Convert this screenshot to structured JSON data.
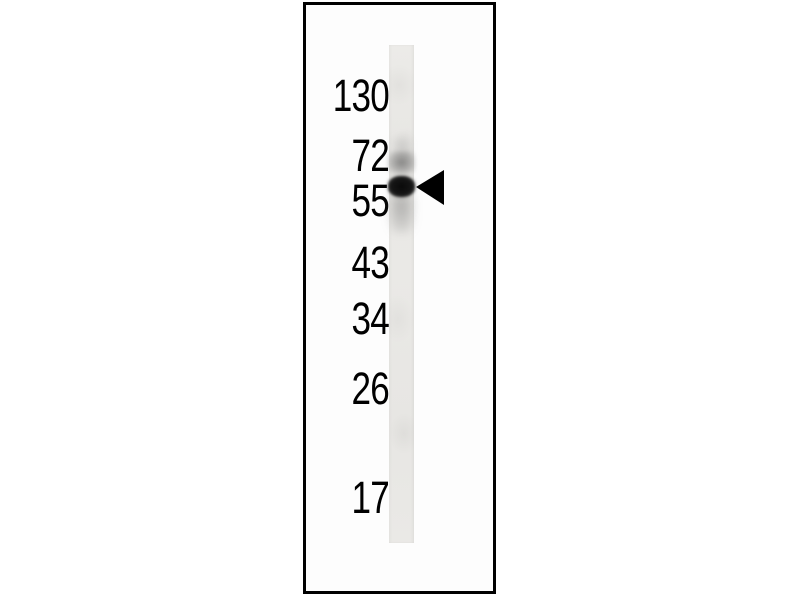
{
  "blot": {
    "figure_kind": "western-blot single lane with molecular weight ladder",
    "marker_labels": [
      "130",
      "72",
      "55",
      "43",
      "34",
      "26",
      "17"
    ],
    "bands": [
      {
        "position": "near 72 marker",
        "intensity": "faint"
      },
      {
        "position": "just above 55 marker",
        "intensity": "strong",
        "marked": "left-pointing arrowhead"
      }
    ],
    "arrowhead_icon": "left-pointing filled triangle",
    "colors": {
      "page_background": "#ffffff",
      "panel_border": "#000000",
      "panel_background": "#fdfdfd",
      "lane_base": "#e9e8e5",
      "band_strong": "#141414",
      "band_faint": "#6e6e6e",
      "label_text": "#000000",
      "arrowhead": "#000000"
    }
  }
}
